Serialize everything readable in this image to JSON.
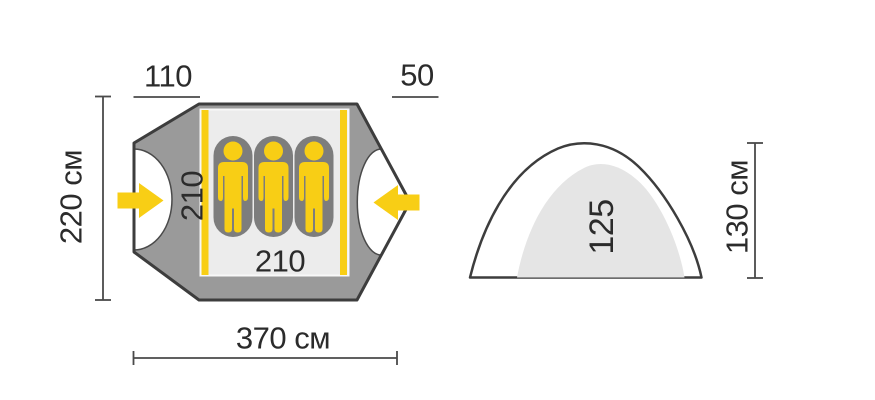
{
  "floor_plan": {
    "persons": 3,
    "labels": {
      "left_vestibule_depth": "110",
      "right_vestibule_depth": "50",
      "outer_width": "220 см",
      "inner_width": "210",
      "inner_length": "210",
      "total_length": "370 см"
    }
  },
  "side_view": {
    "labels": {
      "inner_height": "125",
      "outer_height": "130 см"
    }
  },
  "colors": {
    "accent_yellow": "#F8CE15",
    "tent_gray": "#9A9A9A",
    "outline_dark": "#3D3D3D",
    "floor_light": "#ECECEC",
    "mat_gray": "#7D7D7D",
    "dome_inner": "#E5E5E5",
    "dim_line": "#4A4A4A",
    "text_dark": "#2B2B2B"
  }
}
